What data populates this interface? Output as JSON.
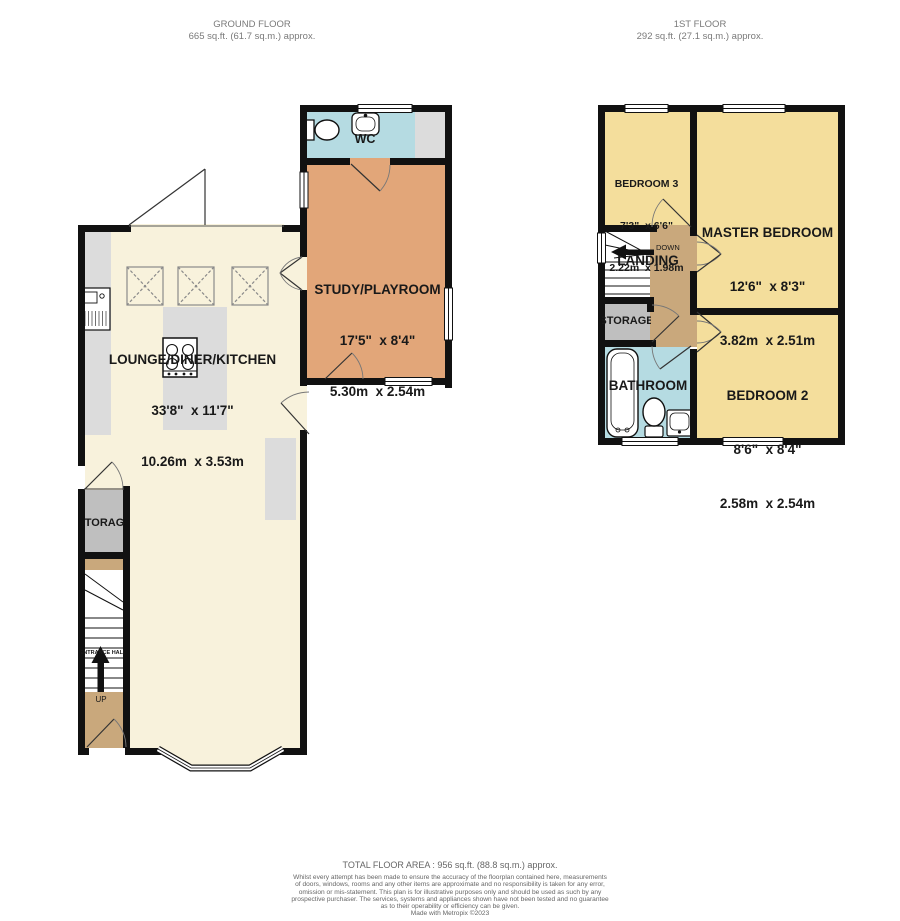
{
  "colors": {
    "wall": "#111111",
    "cream": "#F8F2DC",
    "orange": "#E2A679",
    "yellow": "#F4DE9C",
    "tan": "#C9A87C",
    "blue": "#B5DBE2",
    "room_gray": "#BFBFBF",
    "counter_gray": "#DCDCDC",
    "white": "#FFFFFF"
  },
  "headers": {
    "ground": {
      "title": "GROUND FLOOR",
      "area": "665 sq.ft. (61.7 sq.m.) approx."
    },
    "first": {
      "title": "1ST FLOOR",
      "area": "292 sq.ft. (27.1 sq.m.) approx."
    }
  },
  "ground_floor": {
    "wc": {
      "name": "WC"
    },
    "study": {
      "name": "STUDY/PLAYROOM",
      "imperial": "17'5\"  x 8'4\"",
      "metric": "5.30m  x 2.54m"
    },
    "lounge": {
      "name": "LOUNGE/DINER/KITCHEN",
      "imperial": "33'8\"  x 11'7\"",
      "metric": "10.26m  x 3.53m"
    },
    "storage": {
      "name": "STORAGE"
    },
    "entrance_hall": {
      "name": "ENTRANCE HALL",
      "up": "UP"
    }
  },
  "first_floor": {
    "bedroom3": {
      "name": "BEDROOM 3",
      "imperial": "7'3\"  x 6'6\"",
      "metric": "2.22m  x 1.98m"
    },
    "master": {
      "name": "MASTER BEDROOM",
      "imperial": "12'6\"  x 8'3\"",
      "metric": "3.82m  x 2.51m"
    },
    "bedroom2": {
      "name": "BEDROOM 2",
      "imperial": "8'6\"  x 8'4\"",
      "metric": "2.58m  x 2.54m"
    },
    "landing": {
      "name": "LANDING",
      "down": "DOWN"
    },
    "storage": {
      "name": "STORAGE"
    },
    "bathroom": {
      "name": "BATHROOM"
    }
  },
  "footer": {
    "total": "TOTAL FLOOR AREA : 956 sq.ft. (88.8 sq.m.) approx.",
    "disclaimer_lines": [
      "Whilst every attempt has been made to ensure the accuracy of the floorplan contained here, measurements",
      "of doors, windows, rooms and any other items are approximate and no responsibility is taken for any error,",
      "omission or mis-statement. This plan is for illustrative purposes only and should be used as such by any",
      "prospective purchaser. The services, systems and appliances shown have not been tested and no guarantee",
      "as to their operability or efficiency can be given."
    ],
    "credit": "Made with Metropix ©2023"
  }
}
